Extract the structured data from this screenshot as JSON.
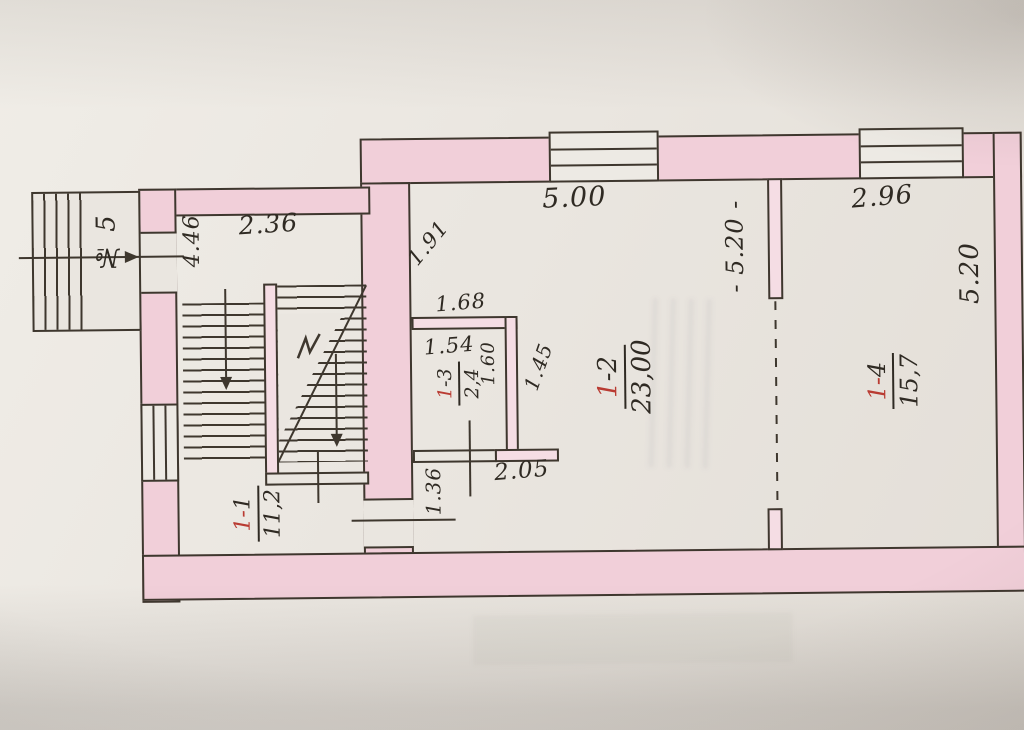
{
  "palette": {
    "paper": "#eae6e0",
    "ink": "#3e372e",
    "handwriting": "#2f2a23",
    "red_ink": "#b93b32",
    "wall_pink": "#f1cfd9",
    "wall_pink_light": "#f5dde4"
  },
  "plan": {
    "apartment_no": "№ 5",
    "rooms": [
      {
        "id": "1-1",
        "num_red": "1-",
        "num_black": "1",
        "area": "11,2"
      },
      {
        "id": "1-2",
        "num_red": "1",
        "num_black": "-2",
        "area": "23,00"
      },
      {
        "id": "1-3",
        "num_red": "1",
        "num_black": "-3",
        "area": "2,4"
      },
      {
        "id": "1-4",
        "num_red": "1-",
        "num_black": "4",
        "area": "15,7"
      }
    ],
    "dimensions": {
      "stair_hall_width": "2.36",
      "stair_hall_depth": "4.46",
      "room12_corner": "1.91",
      "room12_width": "5.00",
      "room14_width": "2.96",
      "partition_length": "- 5.20 -",
      "room14_depth": "5.20",
      "room13_top": "1.68",
      "room13_inner_width": "1.54",
      "room13_inner_depth": "1.60",
      "room13_outer_depth": "1.45",
      "room13_bottom": "2.05",
      "hall_door_width": "1.36"
    }
  }
}
